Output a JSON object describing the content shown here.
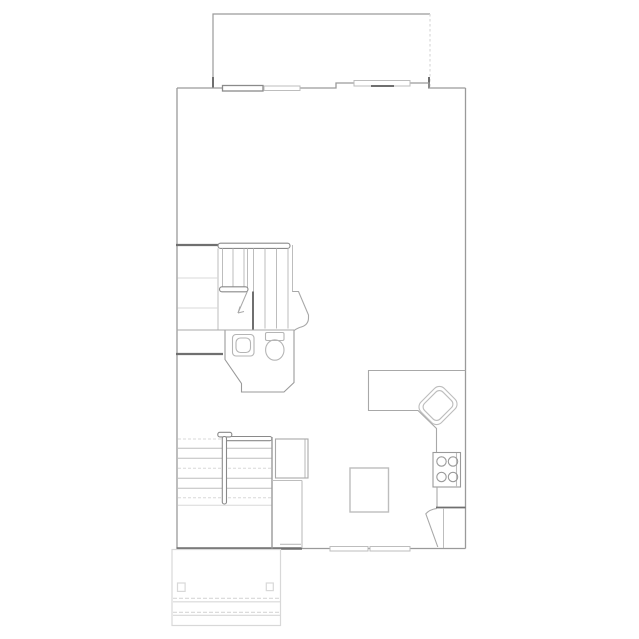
{
  "canvas": {
    "width": 639,
    "height": 639,
    "background": "#ffffff"
  },
  "drawing": {
    "kind": "architectural-floor-plan",
    "level": "main-floor",
    "rooms": [
      "upper-deck",
      "hall",
      "stair-up",
      "bathroom",
      "living-area",
      "kitchen",
      "stair-down",
      "entry-vestibule",
      "front-porch"
    ],
    "fixtures": [
      "toilet",
      "vanity-sink",
      "kitchen-corner-sink",
      "range-4-burner",
      "kitchen-island",
      "l-shaped-counter",
      "closet",
      "entry-door",
      "stair-railings",
      "porch-posts",
      "porch-steps"
    ],
    "window_count": 5,
    "text_labels": []
  },
  "colors": {
    "background": "#ffffff",
    "wall_dark": "#6f6f6f",
    "wall": "#9a9a9a",
    "line_medium": "#a8a8a8",
    "line_light": "#bdbdbd",
    "line_faint": "#d8d8d8",
    "fixture": "#b5b5b5",
    "rail": "#8a8a8a"
  }
}
